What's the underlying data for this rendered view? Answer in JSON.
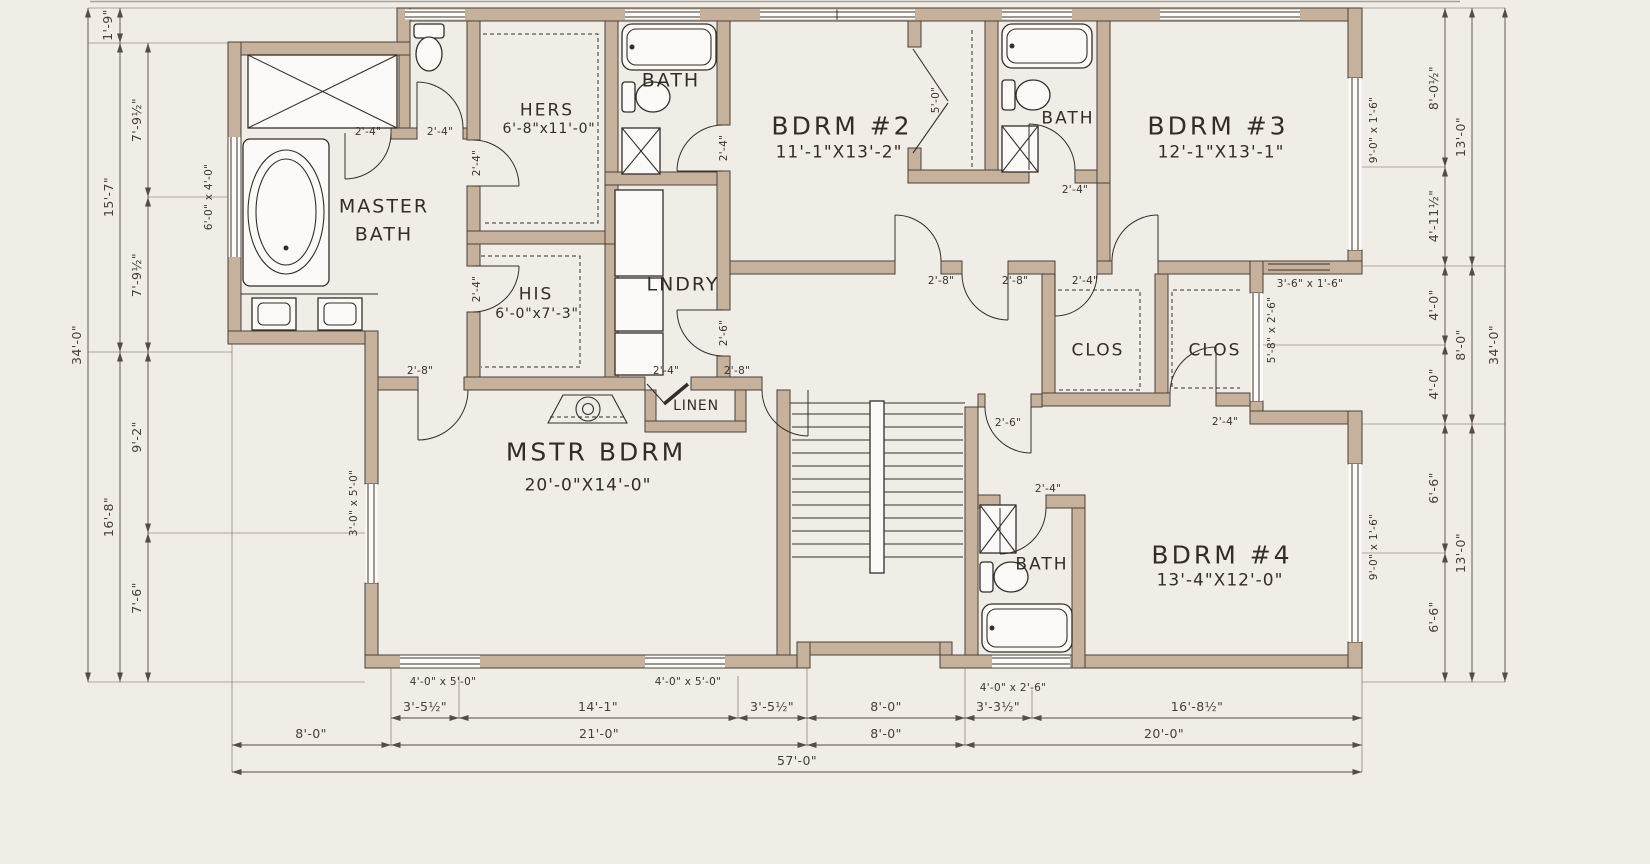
{
  "drawing_type": "floor-plan",
  "colors": {
    "background": "#f0ede7",
    "wall_fill": "#c6b29c",
    "wall_edge": "#4a4038",
    "line": "#332e29",
    "dim_line": "#554c44"
  },
  "rooms": {
    "master_bath": {
      "line1": "MASTER",
      "line2": "BATH"
    },
    "hers": {
      "name": "HERS",
      "size": "6'-8\"x11'-0\""
    },
    "his": {
      "name": "HIS",
      "size": "6'-0\"x7'-3\""
    },
    "bath_hall": {
      "name": "BATH"
    },
    "laundry": {
      "name": "LNDRY"
    },
    "linen": {
      "name": "LINEN"
    },
    "master_bedroom": {
      "name": "MSTR BDRM",
      "size": "20'-0\"X14'-0\""
    },
    "bedroom2": {
      "name": "BDRM #2",
      "size": "11'-1\"X13'-2\""
    },
    "bath2": {
      "name": "BATH"
    },
    "bedroom3": {
      "name": "BDRM #3",
      "size": "12'-1\"X13'-1\""
    },
    "closet1": {
      "name": "CLOS"
    },
    "closet2": {
      "name": "CLOS"
    },
    "bath3": {
      "name": "BATH"
    },
    "bedroom4": {
      "name": "BDRM #4",
      "size": "13'-4\"X12'-0\""
    }
  },
  "doors": {
    "wc_passage": "2'-4\"",
    "wc": "2'-4\"",
    "hers": "2'-4\"",
    "his": "2'-4\"",
    "bath_hall": "2'-4\"",
    "laundry": "2'-6\"",
    "master_w": "2'-8\"",
    "linen": "2'-4\"",
    "master_e": "2'-8\"",
    "bedroom2": "2'-8\"",
    "hall": "2'-8\"",
    "bedroom3": "2'-4\"",
    "closet2": "2'-4\"",
    "hall_stair": "2'-6\"",
    "bath3": "2'-4\"",
    "bath2": "2'-4\"",
    "closet_bifold": "5'-0\""
  },
  "windows": {
    "master_tub": "6'-0\" x 4'-0\"",
    "master_bedroom": "3'-0\" x 5'-0\"",
    "bedroom3": "9'-0\" x 1'-6\"",
    "closet": "5'-8\" x 2'-6\"",
    "step": "3'-6\" x 1'-6\"",
    "bedroom4": "9'-0\" x 1'-6\"",
    "bottom1": "4'-0\" x 5'-0\"",
    "bottom2": "4'-0\" x 5'-0\"",
    "bath_bump": "4'-0\" x 2'-6\""
  },
  "dims": {
    "left": {
      "s1": "1'-9\"",
      "s2": "7'-9½\"",
      "s3": "15'-7\"",
      "s4": "7'-9½\"",
      "s5": "9'-2\"",
      "s6": "16'-8\"",
      "s7": "7'-6\"",
      "total": "34'-0\""
    },
    "right": {
      "s1": "8'-0½\"",
      "s2": "13'-0\"",
      "s3": "4'-11½\"",
      "s4": "4'-0\"",
      "s5": "8'-0\"",
      "s6": "4'-0\"",
      "s7": "6'-6\"",
      "s8": "13'-0\"",
      "s9": "6'-6\"",
      "total": "34'-0\""
    },
    "bottom": {
      "s1": "3'-5½\"",
      "s2": "14'-1\"",
      "s3": "3'-5½\"",
      "s4": "8'-0\"",
      "s5": "3'-3½\"",
      "s6": "16'-8½\"",
      "r2a": "8'-0\"",
      "r2b": "21'-0\"",
      "r2c": "8'-0\"",
      "r2d": "20'-0\"",
      "total": "57'-0\""
    }
  }
}
